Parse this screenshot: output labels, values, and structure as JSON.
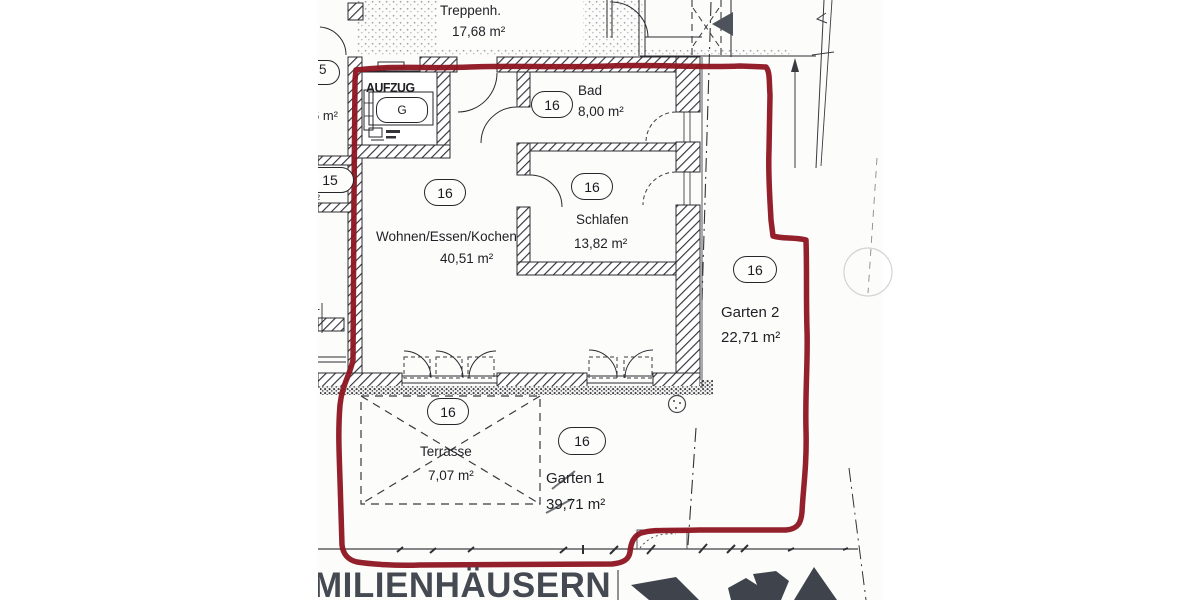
{
  "rooms": {
    "treppenhaus": {
      "name": "Treppenh.",
      "area": "17,68 m²"
    },
    "aufzug": {
      "name": "AUFZUG",
      "car_label": "G"
    },
    "bad": {
      "name": "Bad",
      "area": "8,00 m²",
      "unit": "16"
    },
    "wohnen": {
      "name": "Wohnen/Essen/Kochen",
      "area": "40,51 m²",
      "unit": "16"
    },
    "schlafen": {
      "name": "Schlafen",
      "area": "13,82 m²",
      "unit": "16"
    },
    "terrasse": {
      "name": "Terrasse",
      "area": "7,07 m²",
      "unit": "16"
    },
    "garten1": {
      "name": "Garten 1",
      "area": "39,71 m²",
      "unit": "16"
    },
    "garten2": {
      "name": "Garten 2",
      "area": "22,71 m²",
      "unit": "16"
    }
  },
  "neighbor_fragments": {
    "unit15": "15",
    "unit5": "5",
    "area_fragment": "6 m²",
    "sup_fragment": "²",
    "digit_fragment": "1"
  },
  "footer": {
    "headline_fragment": "MILIENHÄUSERN"
  },
  "colors": {
    "boundary_red": "#8d1420",
    "ink": "#2b2b31",
    "footer_text": "#454a52",
    "logo": "#3f444c"
  }
}
